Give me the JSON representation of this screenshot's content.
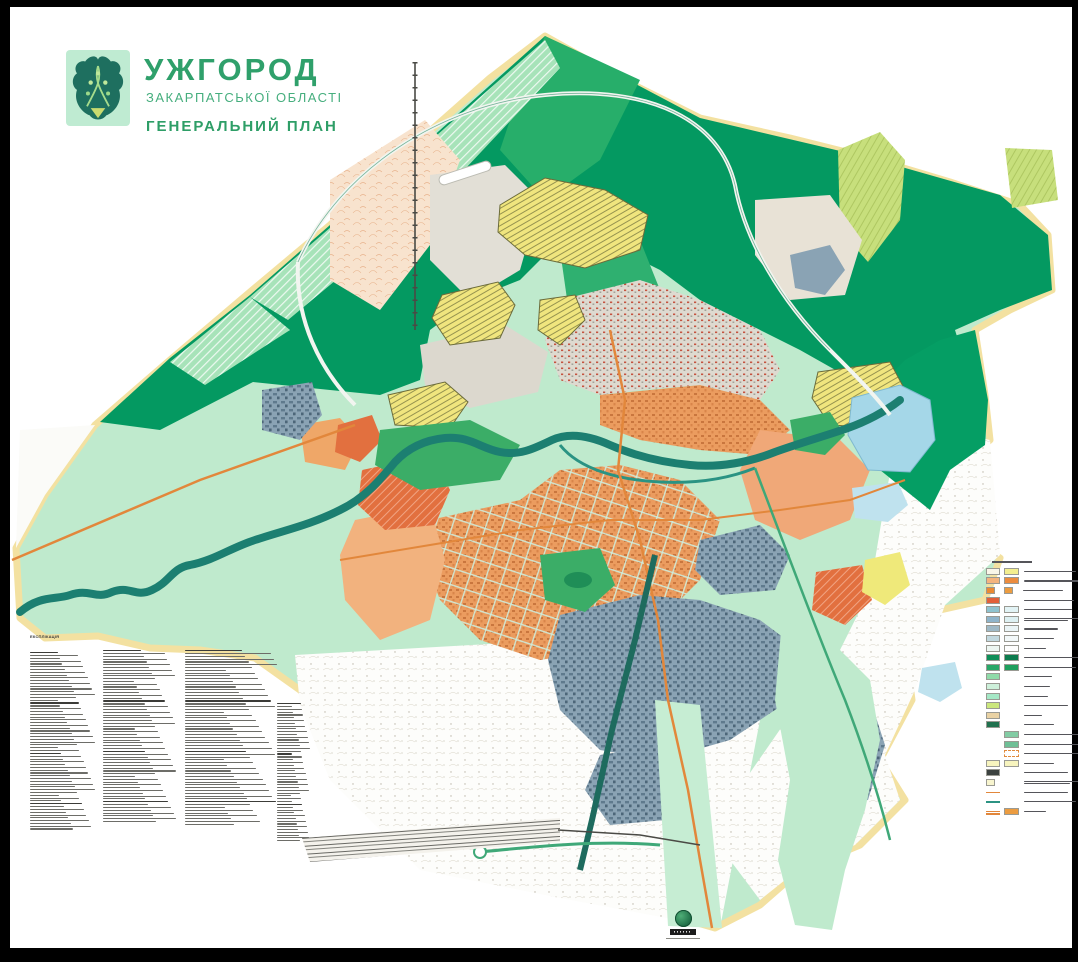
{
  "document": {
    "type": "city-master-plan-map",
    "frame_color": "#000000",
    "canvas_color": "#ffffff"
  },
  "title_block": {
    "city": "УЖГОРОД",
    "region": "ЗАКАРПАТСЬКОЇ ОБЛАСТІ",
    "plan": "ГЕНЕРАЛЬНИЙ ПЛАН",
    "title_color": "#2FA06B",
    "emblem": {
      "background": "#BFEBD2",
      "shield": "#1E6F5F",
      "vine": "#A6DC8C",
      "base_triangle": "#C9DB6F"
    }
  },
  "map": {
    "palette": {
      "forest_dark": "#049961",
      "forest_mid": "#27AE6A",
      "fields_mint": "#BFEACD",
      "fields_pale": "#DFF4E4",
      "boundary_band": "#F3E1A1",
      "river": "#1C7F71",
      "lake": "#A5D7E8",
      "residential_yellow": "#F0E57E",
      "built_orange": "#EB9C5F",
      "built_salmon": "#F2B27E",
      "redevelopment_red": "#E2703F",
      "industrial_blue": "#8AA3B4",
      "civic_lightblue": "#BFE2EE",
      "oldtown_gray": "#DEDAD0",
      "hills_lime": "#C7DF7C",
      "road_orange": "#E2873B",
      "parkway_teal": "#1E6B5E",
      "park_green": "#3BAD67"
    }
  },
  "explication": {
    "header": "ЕКСПЛІКАЦІЯ",
    "note": "numbered micro-text lists, illegible at source resolution",
    "columns": [
      {
        "x": 30,
        "y": 652,
        "w": 66,
        "lines": 64
      },
      {
        "x": 103,
        "y": 650,
        "w": 74,
        "lines": 62
      },
      {
        "x": 185,
        "y": 650,
        "w": 92,
        "lines": 63
      },
      {
        "x": 277,
        "y": 703,
        "w": 33,
        "lines": 50
      }
    ]
  },
  "legend_right": {
    "note": "labels illegible at source resolution",
    "rows": [
      {
        "l": {
          "c": "#F9F6E8",
          "p": "dots"
        },
        "r": {
          "c": "#F3EE8E"
        },
        "lw": 52
      },
      {
        "l": {
          "c": "#F4B47E"
        },
        "r": {
          "c": "#EC8C3E"
        },
        "lw": 56
      },
      {
        "l": {
          "c": "#EA8A33",
          "sm": true
        },
        "r": {
          "c": "#EC9C40",
          "sm": true
        },
        "lw": 40
      },
      {
        "l": {
          "c": "#E2603A",
          "p": "hatch"
        },
        "r": null,
        "lw": 50
      },
      {
        "l": {
          "c": "#8FC3CF"
        },
        "r": {
          "c": "#E2F3F5"
        },
        "lw": 48
      },
      {
        "l": {
          "c": "#8FB4CA",
          "p": "grid"
        },
        "r": {
          "c": "#DDF0F2",
          "p": "grid"
        },
        "lw": 54,
        "lines": 2
      },
      {
        "l": {
          "c": "#9FB9C6",
          "p": "grid"
        },
        "r": {
          "c": "#EAF4F6",
          "p": "grid"
        },
        "lw": 34
      },
      {
        "l": {
          "c": "#C2D8DF"
        },
        "r": {
          "c": "#F2F8F9"
        },
        "lw": 30
      },
      {
        "l": {
          "c": "#EDF6F2"
        },
        "r": {
          "c": "#FEFEFE"
        },
        "lw": 22
      },
      {
        "l": {
          "c": "#0F8E58"
        },
        "r": {
          "c": "#0C7B4D"
        },
        "lw": 56
      },
      {
        "l": {
          "c": "#29A868"
        },
        "r": {
          "c": "#1FA05E"
        },
        "lw": 52
      },
      {
        "l": {
          "c": "#90DBA9"
        },
        "r": null,
        "lw": 28
      },
      {
        "l": {
          "c": "#CDF0DA"
        },
        "r": null,
        "lw": 26
      },
      {
        "l": {
          "c": "#A5E8C6"
        },
        "r": null,
        "lw": 24
      },
      {
        "l": {
          "c": "#CBE77D"
        },
        "r": null,
        "lw": 44
      },
      {
        "l": {
          "c": "#E9D2A4"
        },
        "r": null,
        "lw": 18
      },
      {
        "l": {
          "c": "#20714E"
        },
        "r": null,
        "lw": 30
      },
      {
        "l": null,
        "r": {
          "c": "#83CCA4",
          "p": "hatchg"
        },
        "lw": 58
      },
      {
        "l": null,
        "r": {
          "c": "#6FBF96",
          "p": "hatchg"
        },
        "lw": 56
      },
      {
        "l": null,
        "r": {
          "c": "#FFFFFF",
          "p": "dash"
        },
        "lw": 56
      },
      {
        "l": {
          "c": "#F7F4BE"
        },
        "r": {
          "c": "#F7F4BE"
        },
        "lw": 30
      },
      {
        "l": {
          "c": "#3C4240"
        },
        "r": null,
        "lw": 44
      },
      {
        "l": {
          "c": "#F8F5CF",
          "sm": true
        },
        "r": null,
        "lw": 56,
        "lines": 2
      },
      {
        "l": {
          "sym": "line",
          "c": "#E2873B"
        },
        "r": null,
        "lw": 44
      },
      {
        "l": {
          "sym": "line",
          "c": "#2C9383"
        },
        "r": null,
        "lw": 52
      },
      {
        "l": {
          "sym": "dbl",
          "c": "#E2873B"
        },
        "r": {
          "c": "#EC9C40"
        },
        "lw": 22
      }
    ]
  },
  "footer_logo": {
    "shape": "green-globe-emblem",
    "banner_color": "#1c1c1c",
    "caption_note": "micro caption line, illegible"
  }
}
